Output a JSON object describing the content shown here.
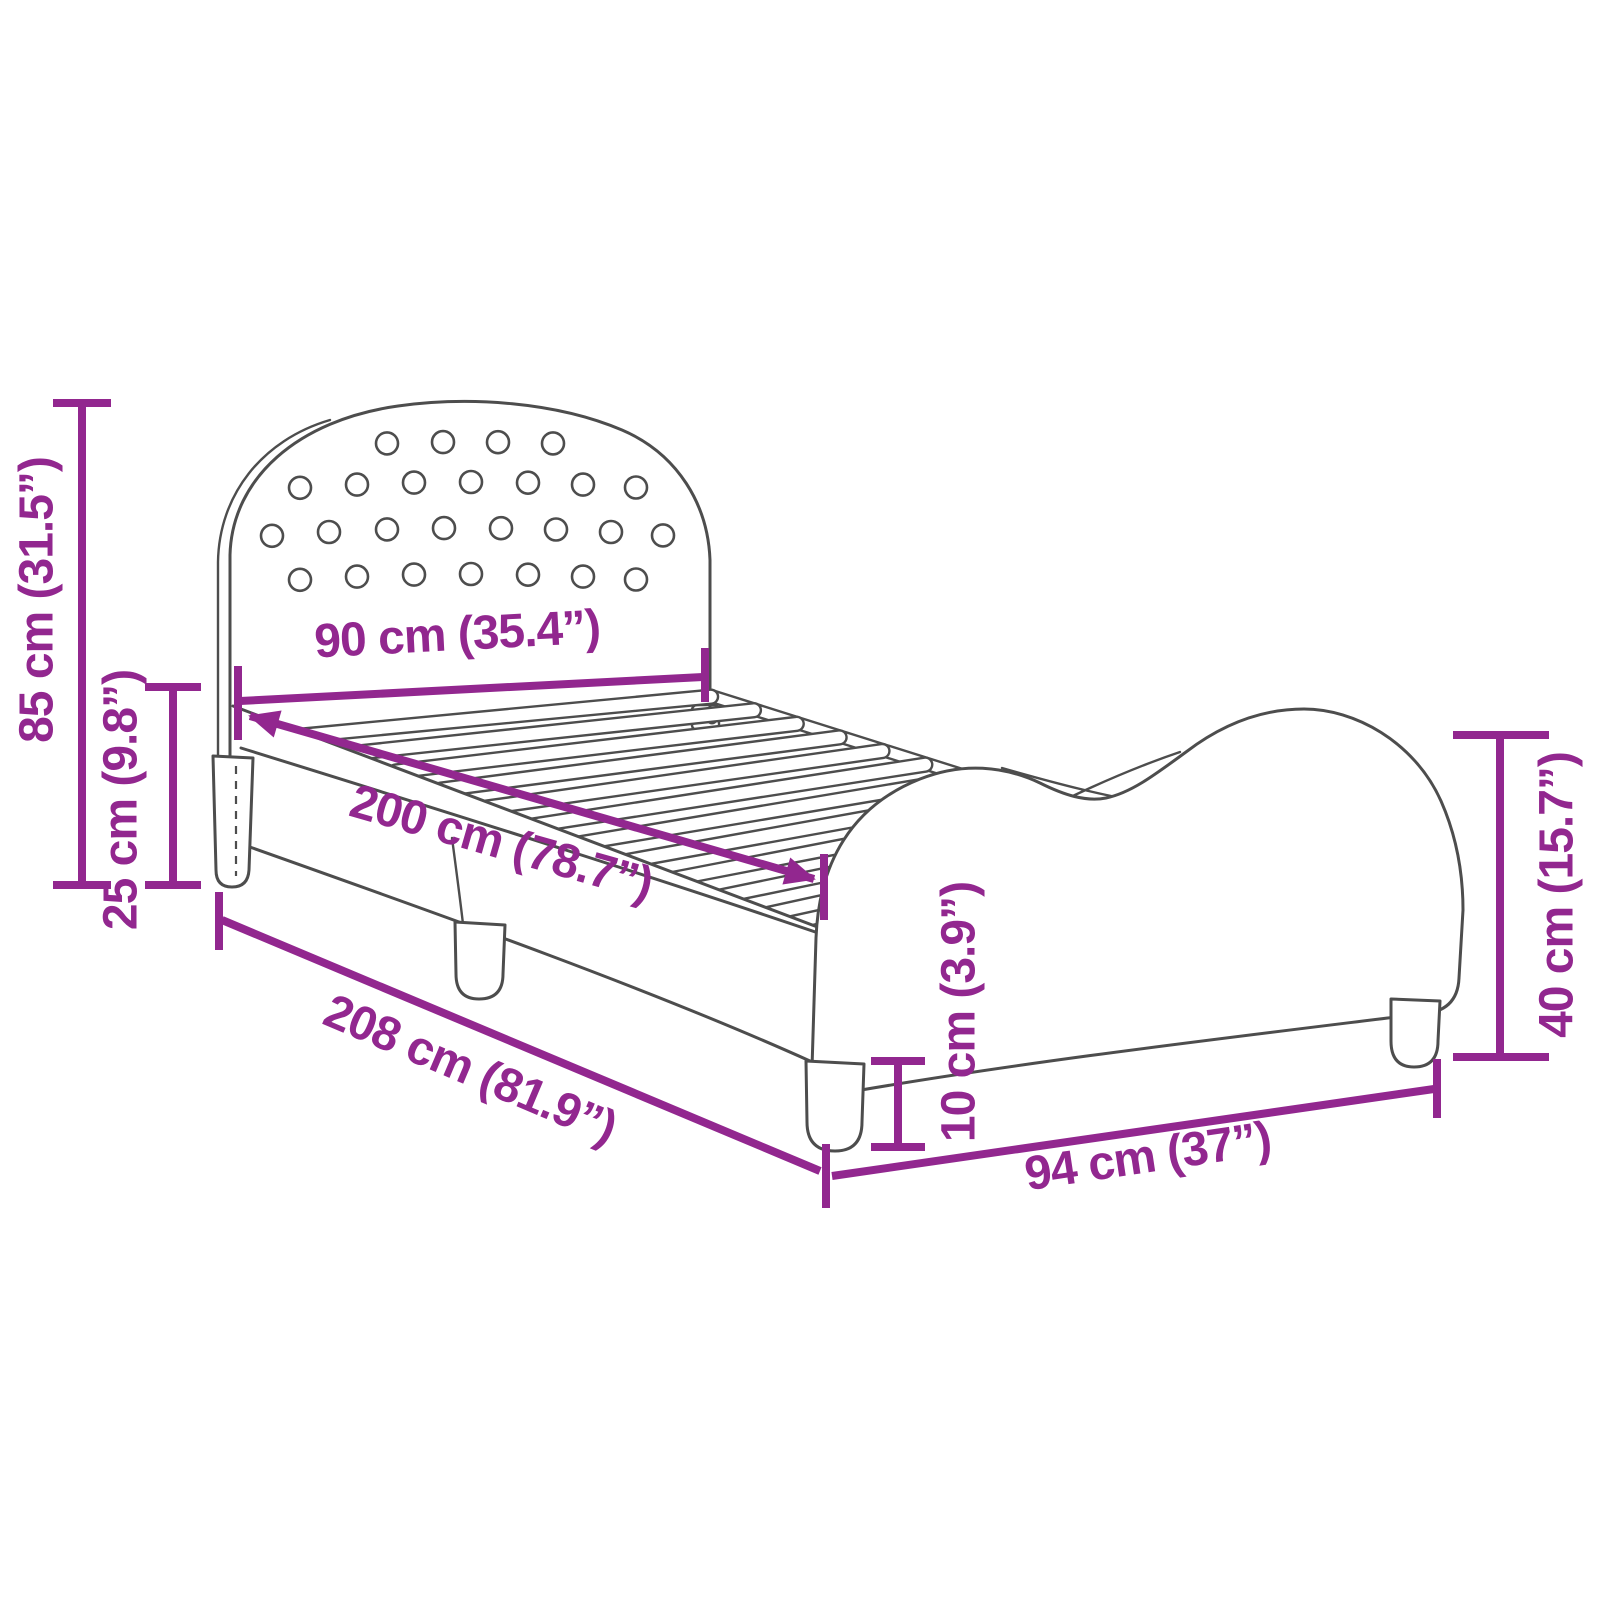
{
  "diagram": {
    "type": "product-dimension-diagram",
    "subject": "bed-frame-with-headboard-and-wavy-side-panels",
    "colors": {
      "dimension_accent": "#92278F",
      "line_art": "#4D4D4D",
      "background": "#FFFFFF"
    },
    "dimensions": {
      "headboard_height": {
        "label": "85 cm (31.5”)",
        "cm": 85,
        "inches": 31.5
      },
      "side_rail_height": {
        "label": "25 cm (9.8”)",
        "cm": 25,
        "inches": 9.8
      },
      "headboard_width": {
        "label": "90 cm (35.4”)",
        "cm": 90,
        "inches": 35.4
      },
      "mattress_length": {
        "label": "200 cm (78.7”)",
        "cm": 200,
        "inches": 78.7
      },
      "total_length": {
        "label": "208 cm (81.9”)",
        "cm": 208,
        "inches": 81.9
      },
      "total_width": {
        "label": "94 cm (37”)",
        "cm": 94,
        "inches": 37
      },
      "footboard_height": {
        "label": "40 cm (15.7”)",
        "cm": 40,
        "inches": 15.7
      },
      "leg_height": {
        "label": "10 cm (3.9”)",
        "cm": 10,
        "inches": 3.9
      }
    }
  }
}
